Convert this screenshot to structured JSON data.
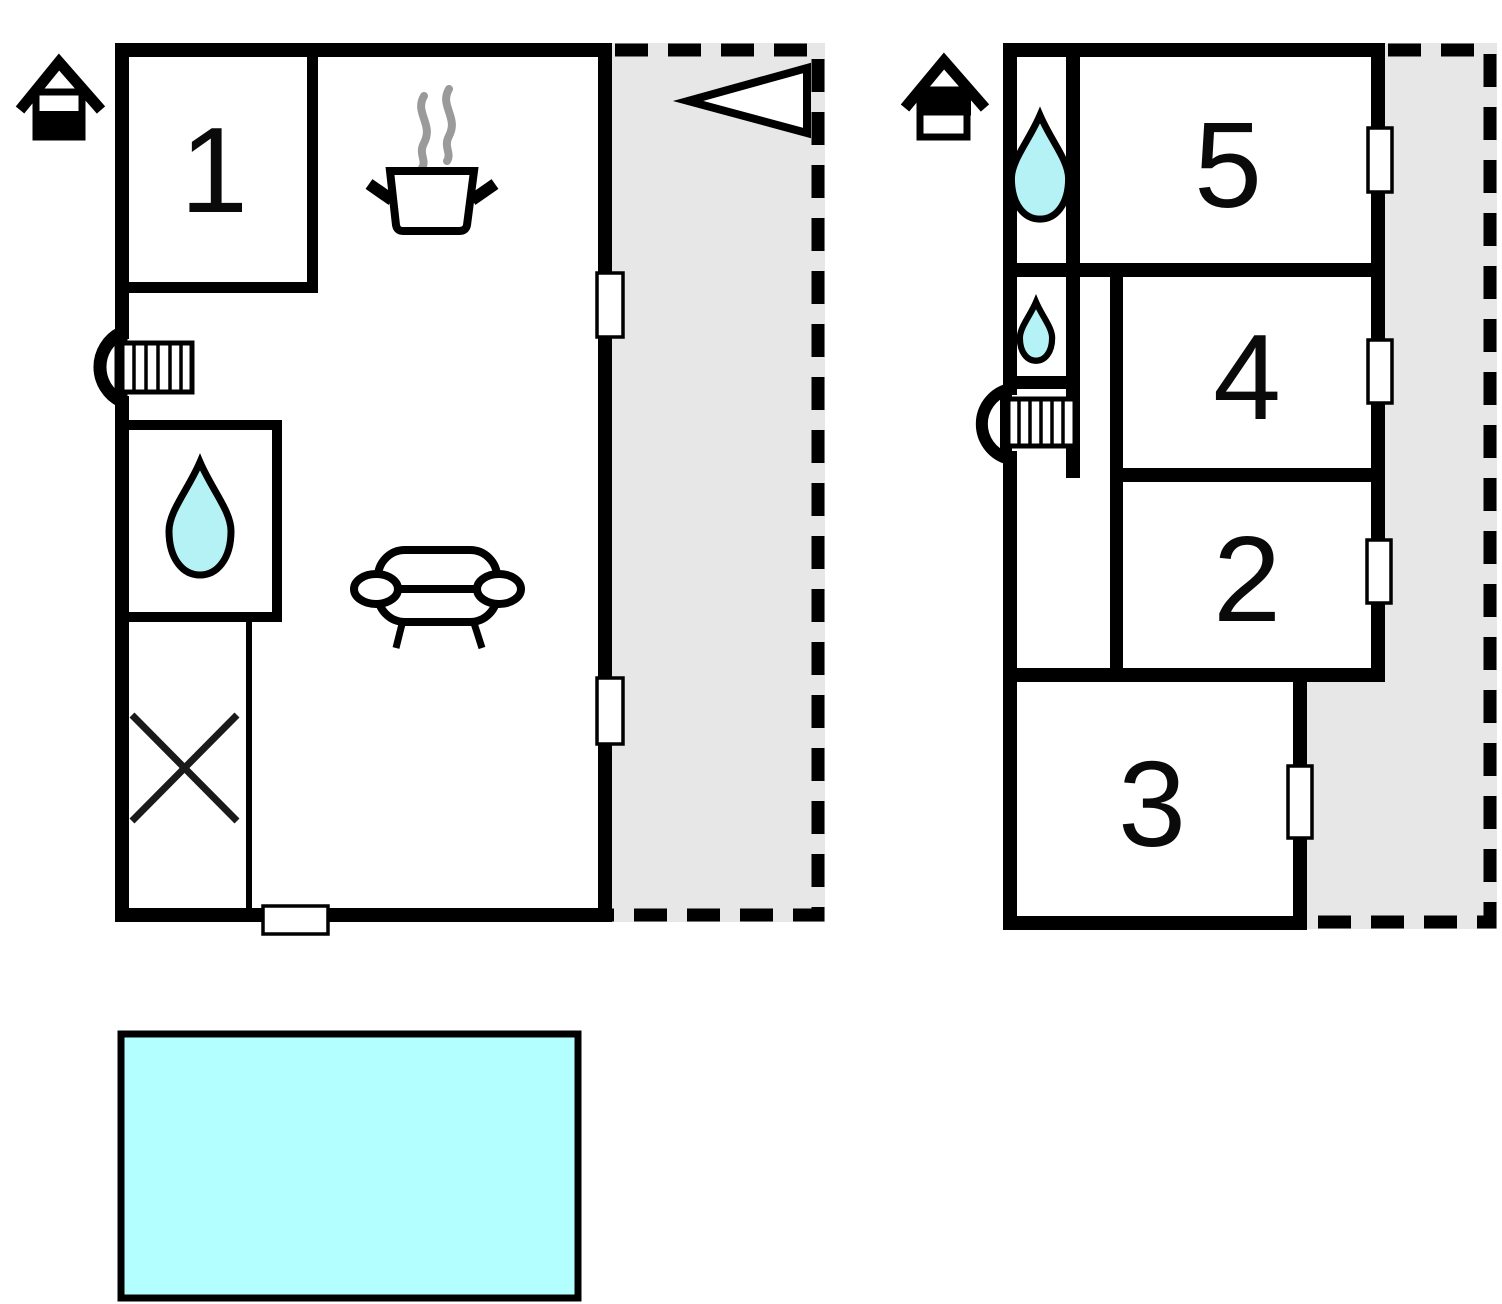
{
  "diagram_type": "floor-plan",
  "floors": [
    {
      "name": "ground-floor",
      "indicator_icon": "house-lower-half-filled",
      "rooms": [
        {
          "label": "1"
        }
      ],
      "icons": [
        "stove-pot-icon",
        "steam-icon",
        "water-drop-icon",
        "sofa-icon",
        "stairs-icon",
        "crossed-area-icon",
        "direction-arrow-icon"
      ]
    },
    {
      "name": "upper-floor",
      "indicator_icon": "house-upper-half-filled",
      "rooms": [
        {
          "label": "5"
        },
        {
          "label": "4"
        },
        {
          "label": "2"
        },
        {
          "label": "3"
        }
      ],
      "icons": [
        "water-drop-icon",
        "small-water-drop-icon",
        "stairs-icon"
      ]
    }
  ],
  "labels": {
    "room1": "1",
    "room2": "2",
    "room3": "3",
    "room4": "4",
    "room5": "5"
  },
  "colors": {
    "wall": "#000000",
    "water": "#b4f2f6",
    "pool": "#b3ffff",
    "terrace": "#e7e7e7",
    "steam": "#9a9a9a",
    "background": "#ffffff"
  }
}
